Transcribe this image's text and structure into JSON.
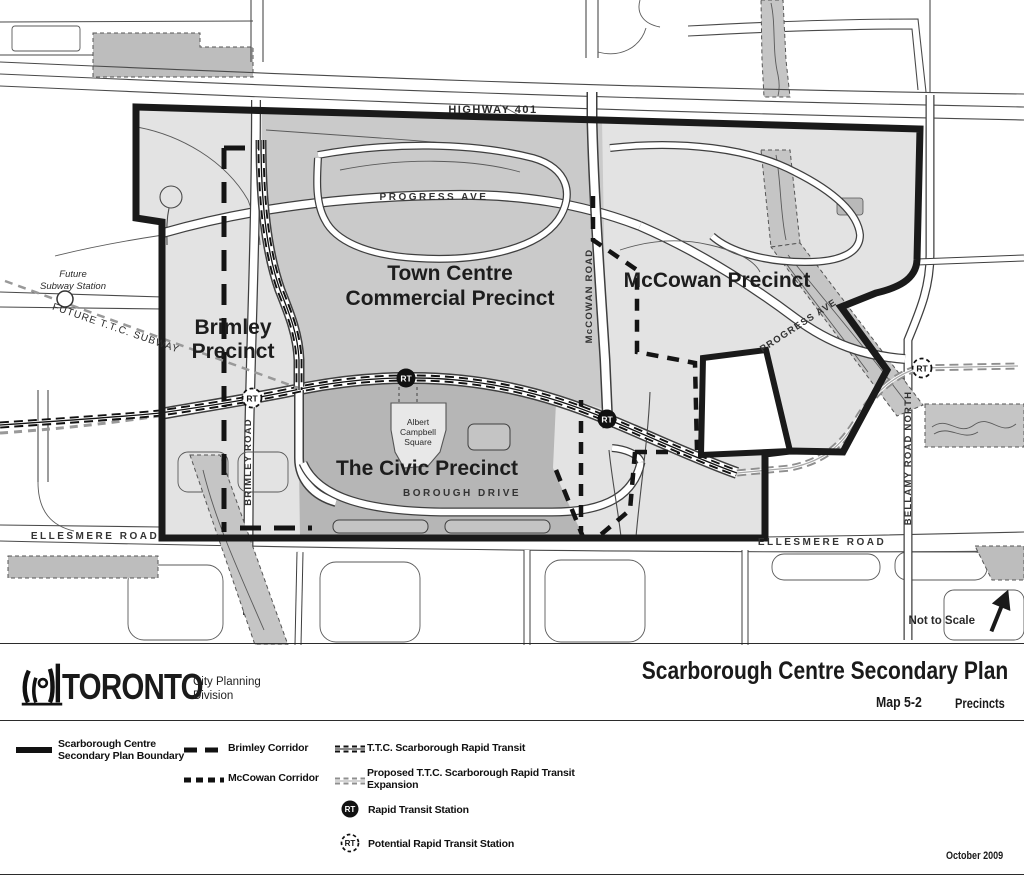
{
  "map": {
    "labels": {
      "highway": "HIGHWAY 401",
      "progress_w": "PROGRESS AVE",
      "progress_e": "PROGRESS AVE",
      "future_station_1": "Future",
      "future_station_2": "Subway Station",
      "future_subway": "FUTURE T.T.C. SUBWAY",
      "brimley_1": "Brimley",
      "brimley_2": "Precinct",
      "town_1": "Town Centre",
      "town_2": "Commercial Precinct",
      "mccowan": "McCowan Precinct",
      "civic": "The Civic Precinct",
      "road_mccowan": "McCOWAN ROAD",
      "road_brimley": "BRIMLEY ROAD",
      "road_bellamy": "BELLAMY ROAD NORTH",
      "road_borough": "BOROUGH DRIVE",
      "ellesmere_w": "ELLESMERE ROAD",
      "ellesmere_e": "ELLESMERE ROAD",
      "acs_1": "Albert",
      "acs_2": "Campbell",
      "acs_3": "Square",
      "rt": "RT",
      "not_to_scale": "Not to Scale"
    },
    "colors": {
      "boundary": "#1a1a1a",
      "plan_fill": "#e3e3e3",
      "town_centre_fill": "#cacaca",
      "civic_fill": "#b6b6b6",
      "creek_fill": "#c5c5c5",
      "outside_patch_fill": "#bdbdbd"
    }
  },
  "titleblock": {
    "brand": "TORONTO",
    "dept_1": "City Planning",
    "dept_2": "Division",
    "title": "Scarborough Centre Secondary Plan",
    "map_no": "Map 5-2",
    "subtitle": "Precincts"
  },
  "legend": {
    "items": [
      {
        "line1": "Scarborough Centre",
        "line2": "Secondary Plan Boundary"
      },
      {
        "line1": "Brimley Corridor",
        "line2": ""
      },
      {
        "line1": "McCowan Corridor",
        "line2": ""
      },
      {
        "line1": "T.T.C. Scarborough Rapid Transit",
        "line2": ""
      },
      {
        "line1": "Proposed T.T.C. Scarborough Rapid Transit",
        "line2": "Expansion"
      },
      {
        "line1": "Rapid Transit Station",
        "line2": ""
      },
      {
        "line1": "Potential Rapid Transit Station",
        "line2": ""
      }
    ]
  },
  "footer": {
    "date": "October 2009"
  }
}
